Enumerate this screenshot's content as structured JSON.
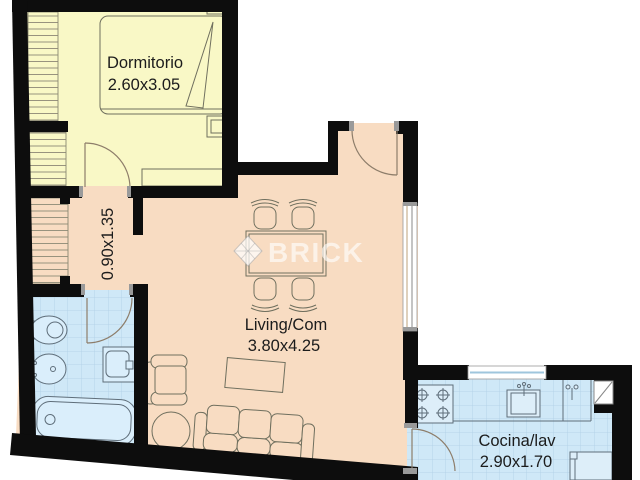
{
  "plan": {
    "watermark": {
      "brand": "BRICK",
      "logo": "diamond-logo"
    },
    "rooms": {
      "dormitorio": {
        "label": "Dormitorio",
        "dims": "2.60x3.05"
      },
      "pasillo": {
        "dims": "0.90x1.35"
      },
      "living": {
        "label": "Living/Com",
        "dims": "3.80x4.25"
      },
      "cocina": {
        "label": "Cocina/lav",
        "dims": "2.90x1.70"
      }
    },
    "colors": {
      "bedroom_floor": "#f9f8c6",
      "living_floor": "#f8dcc2",
      "wet_floor": "#cfe8f7",
      "tile_line": "#afcfe5",
      "wall": "#0d0d0d",
      "furniture_stroke": "#6f6f5e",
      "watermark": "rgba(255,255,255,0.62)"
    }
  }
}
